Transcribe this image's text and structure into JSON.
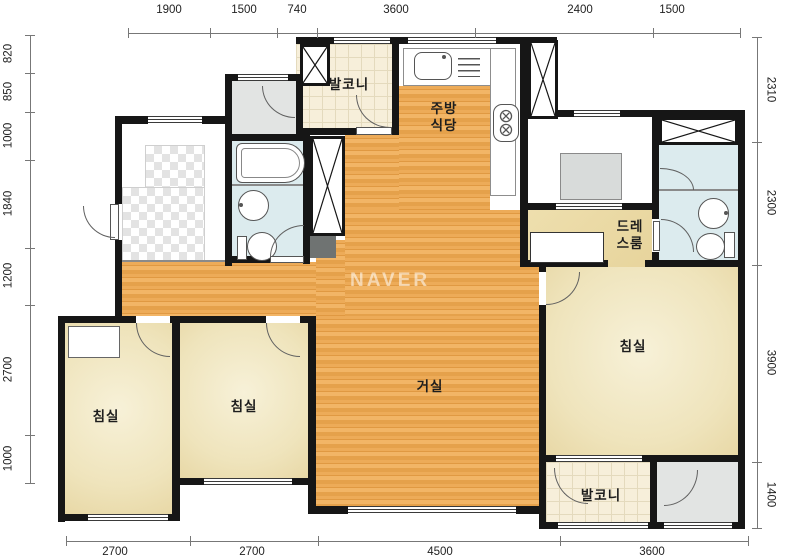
{
  "watermark": "NAVER",
  "rooms": {
    "balcony_top": "발코니",
    "kitchen_line1": "주방",
    "kitchen_line2": "식당",
    "dressroom_line1": "드레",
    "dressroom_line2": "스룸",
    "living": "거실",
    "bedroom_left": "침실",
    "bedroom_middle": "침실",
    "bedroom_master": "침실",
    "balcony_bottom": "발코니"
  },
  "dimensions": {
    "top": [
      "1900",
      "1500",
      "740",
      "3600",
      "2400",
      "1500"
    ],
    "left": [
      "820",
      "850",
      "1000",
      "1840",
      "1200",
      "2700",
      "1000"
    ],
    "right": [
      "2310",
      "2300",
      "3900",
      "1400"
    ],
    "bottom": [
      "2700",
      "2700",
      "4500",
      "3600"
    ]
  },
  "colors": {
    "wall": "#161616",
    "wood_floor": "#e8a54f",
    "bedroom_floor": "#f2ead0",
    "balcony_tile": "#f7efda",
    "bathroom_floor": "#dcebee",
    "dressroom_floor": "#ead8a4",
    "entry_gray": "#e2e4e3"
  }
}
